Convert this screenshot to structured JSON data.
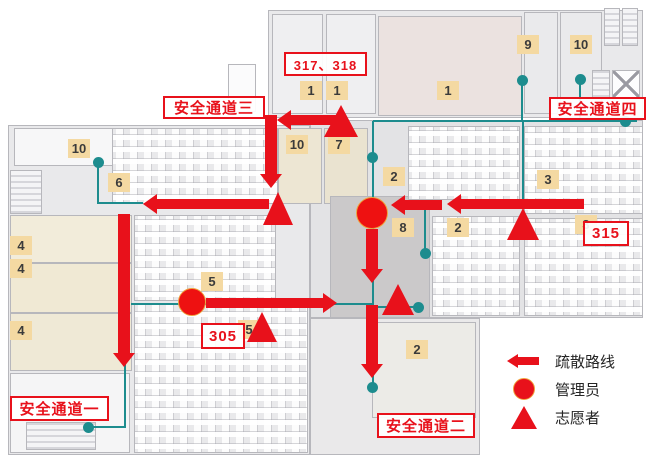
{
  "colors": {
    "route_red": "#e8111b",
    "network_teal": "#1d8c8e",
    "badge_tan": "#f4d9a2"
  },
  "passage_labels": [
    {
      "id": "passage-3",
      "text": "安全通道三",
      "x": 163,
      "y": 96,
      "w": 102,
      "h": 23
    },
    {
      "id": "passage-4",
      "text": "安全通道四",
      "x": 549,
      "y": 97,
      "w": 97,
      "h": 23
    },
    {
      "id": "passage-1",
      "text": "安全通道一",
      "x": 10,
      "y": 396,
      "w": 99,
      "h": 25
    },
    {
      "id": "passage-2",
      "text": "安全通道二",
      "x": 377,
      "y": 413,
      "w": 98,
      "h": 25
    },
    {
      "id": "room-317-318",
      "text": "317、318",
      "x": 284,
      "y": 52,
      "w": 83,
      "h": 24
    },
    {
      "id": "room-315",
      "text": "315",
      "x": 583,
      "y": 221,
      "w": 46,
      "h": 25
    },
    {
      "id": "room-305",
      "text": "305",
      "x": 201,
      "y": 323,
      "w": 44,
      "h": 26
    }
  ],
  "room_badges": [
    {
      "text": "10",
      "x": 78,
      "y": 148
    },
    {
      "text": "6",
      "x": 118,
      "y": 182
    },
    {
      "text": "4",
      "x": 20,
      "y": 245
    },
    {
      "text": "4",
      "x": 20,
      "y": 268
    },
    {
      "text": "4",
      "x": 20,
      "y": 330
    },
    {
      "text": "5",
      "x": 211,
      "y": 281
    },
    {
      "text": "5",
      "x": 248,
      "y": 329
    },
    {
      "text": "10",
      "x": 296,
      "y": 144
    },
    {
      "text": "7",
      "x": 338,
      "y": 144
    },
    {
      "text": "1",
      "x": 310,
      "y": 90
    },
    {
      "text": "1",
      "x": 336,
      "y": 90
    },
    {
      "text": "1",
      "x": 447,
      "y": 90
    },
    {
      "text": "9",
      "x": 527,
      "y": 44
    },
    {
      "text": "10",
      "x": 580,
      "y": 44
    },
    {
      "text": "2",
      "x": 393,
      "y": 176
    },
    {
      "text": "8",
      "x": 402,
      "y": 227
    },
    {
      "text": "2",
      "x": 457,
      "y": 227
    },
    {
      "text": "3",
      "x": 547,
      "y": 179
    },
    {
      "text": "3",
      "x": 585,
      "y": 224
    },
    {
      "text": "2",
      "x": 416,
      "y": 349
    }
  ],
  "legend": {
    "items": [
      {
        "icon": "route-arrow-icon",
        "label": "疏散路线"
      },
      {
        "icon": "manager-circle-icon",
        "label": "管理员"
      },
      {
        "icon": "volunteer-triangle-icon",
        "label": "志愿者"
      }
    ]
  },
  "markers": {
    "managers": [
      {
        "x": 372,
        "y": 213,
        "r": 16
      },
      {
        "x": 192,
        "y": 302,
        "r": 14
      }
    ],
    "volunteers": [
      {
        "cx": 341,
        "top": 105,
        "w": 34,
        "h": 32
      },
      {
        "cx": 278,
        "top": 192,
        "w": 30,
        "h": 33
      },
      {
        "cx": 523,
        "top": 208,
        "w": 33,
        "h": 32
      },
      {
        "cx": 398,
        "top": 284,
        "w": 33,
        "h": 31
      },
      {
        "cx": 262,
        "top": 312,
        "w": 30,
        "h": 30
      }
    ]
  },
  "routes": {
    "arrows": [
      {
        "dir": "left",
        "x": 277,
        "y": 120,
        "len": 50
      },
      {
        "dir": "down",
        "x": 271,
        "y": 188,
        "len": 60
      },
      {
        "dir": "left",
        "x": 143,
        "y": 204,
        "len": 113
      },
      {
        "dir": "down",
        "x": 124,
        "y": 367,
        "len": 140
      },
      {
        "dir": "left",
        "x": 447,
        "y": 204,
        "len": 124
      },
      {
        "dir": "left",
        "x": 391,
        "y": 205,
        "len": 38
      },
      {
        "dir": "down",
        "x": 372,
        "y": 283,
        "len": 41
      },
      {
        "dir": "down",
        "x": 372,
        "y": 378,
        "len": 60
      },
      {
        "dir": "right",
        "x": 337,
        "y": 303,
        "len": 118
      }
    ],
    "teal_lines": [
      {
        "x1": 373,
        "y1": 121,
        "x2": 637,
        "y2": 121
      },
      {
        "x1": 522,
        "y1": 80,
        "x2": 522,
        "y2": 121
      },
      {
        "x1": 580,
        "y1": 79,
        "x2": 580,
        "y2": 121
      },
      {
        "x1": 373,
        "y1": 121,
        "x2": 373,
        "y2": 387
      },
      {
        "x1": 523,
        "y1": 121,
        "x2": 523,
        "y2": 208
      },
      {
        "x1": 425,
        "y1": 204,
        "x2": 425,
        "y2": 253
      },
      {
        "x1": 378,
        "y1": 307,
        "x2": 418,
        "y2": 307
      },
      {
        "x1": 98,
        "y1": 162,
        "x2": 98,
        "y2": 204
      },
      {
        "x1": 98,
        "y1": 203,
        "x2": 143,
        "y2": 203
      },
      {
        "x1": 131,
        "y1": 304,
        "x2": 372,
        "y2": 304
      },
      {
        "x1": 88,
        "y1": 427,
        "x2": 126,
        "y2": 427
      },
      {
        "x1": 125,
        "y1": 310,
        "x2": 125,
        "y2": 427
      }
    ],
    "teal_dots": [
      {
        "x": 98,
        "y": 162
      },
      {
        "x": 372,
        "y": 157
      },
      {
        "x": 425,
        "y": 253
      },
      {
        "x": 418,
        "y": 307
      },
      {
        "x": 522,
        "y": 80
      },
      {
        "x": 580,
        "y": 79
      },
      {
        "x": 625,
        "y": 121
      },
      {
        "x": 88,
        "y": 427
      },
      {
        "x": 372,
        "y": 387
      }
    ]
  }
}
